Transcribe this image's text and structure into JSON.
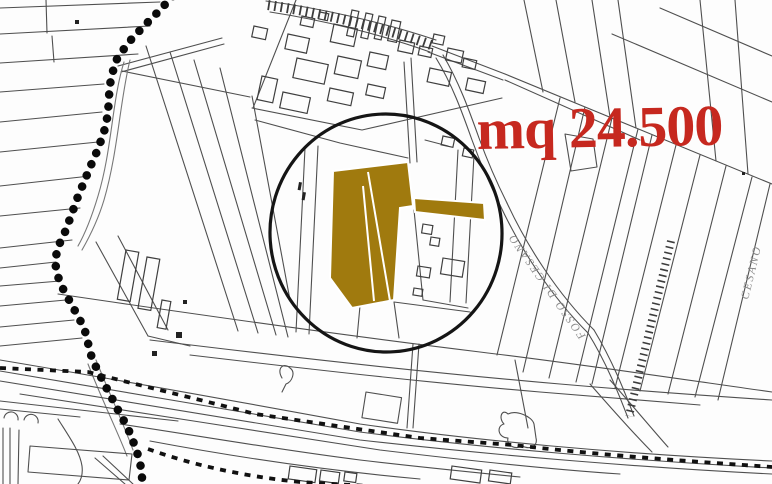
{
  "map": {
    "type": "cadastral-plan",
    "area_label": "mq 24.500",
    "area_label_color": "#c6281f",
    "highlight_color": "#a07a0e",
    "line_color": "#4f4f4f",
    "street_labels": {
      "fosso": "FOSSO DI CESANO",
      "cesano": "CESANO"
    }
  }
}
